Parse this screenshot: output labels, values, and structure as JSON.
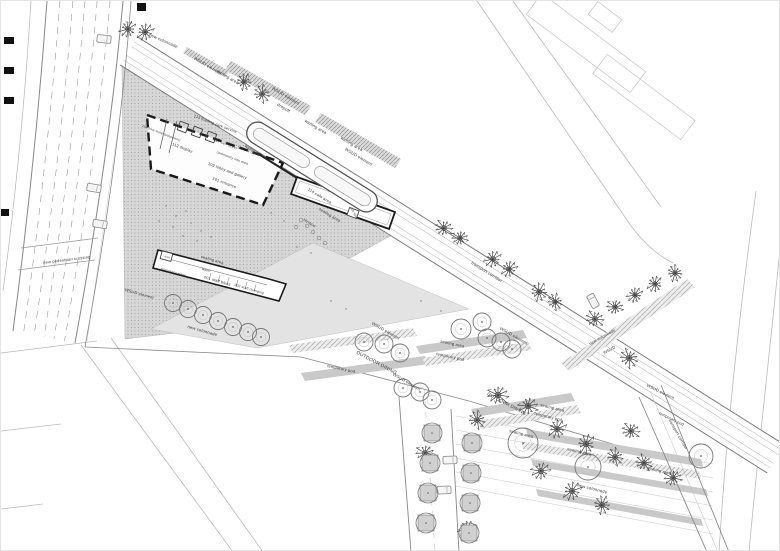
{
  "colors": {
    "paper": "#ffffff",
    "line_dark": "#555555",
    "line_mid": "#888888",
    "line_light": "#bbbbbb",
    "dot_zone_bg": "#d6d6d6",
    "dot_zone_dot": "#9a9a9a",
    "gray_zone": "#e3e3e3",
    "bar_gray": "#c9c9c9",
    "tree_stroke": "#444444",
    "round_tree_stroke": "#777777",
    "label_color": "#333333",
    "building_outline": "#1a1a1a"
  },
  "labels": [
    {
      "text": "new colonnade",
      "x": 162,
      "y": 41,
      "rot": 24,
      "size": 4.2
    },
    {
      "text": "WSUD element",
      "x": 206,
      "y": 66,
      "rot": 31,
      "size": 4.2
    },
    {
      "text": "waiting area",
      "x": 226,
      "y": 77,
      "rot": 31,
      "size": 4.2
    },
    {
      "text": "WSUD element",
      "x": 284,
      "y": 96,
      "rot": 31,
      "size": 4.2
    },
    {
      "text": "dropoff",
      "x": 282,
      "y": 108,
      "rot": 31,
      "size": 4.2
    },
    {
      "text": "waiting area",
      "x": 314,
      "y": 127,
      "rot": 31,
      "size": 4.2
    },
    {
      "text": "waiting area",
      "x": 350,
      "y": 144,
      "rot": 31,
      "size": 4.2
    },
    {
      "text": "WSUD element",
      "x": 357,
      "y": 157,
      "rot": 31,
      "size": 4.2
    },
    {
      "text": "waiting area",
      "x": 254,
      "y": 152,
      "rot": 31,
      "size": 4.2
    },
    {
      "text": "113 loading park service",
      "x": 214,
      "y": 124,
      "rot": 21,
      "size": 3.8
    },
    {
      "text": "104 bike store (basement)",
      "x": 160,
      "y": 133,
      "rot": 21,
      "size": 3.1
    },
    {
      "text": "112 display",
      "x": 181,
      "y": 148,
      "rot": 21,
      "size": 3.9
    },
    {
      "text": "107 self ticket",
      "x": 224,
      "y": 144,
      "rot": 21,
      "size": 3.6
    },
    {
      "text": "community info area",
      "x": 231,
      "y": 158,
      "rot": 21,
      "size": 3.3
    },
    {
      "text": "103 box office",
      "x": 247,
      "y": 151,
      "rot": 21,
      "size": 3.3
    },
    {
      "text": "102 lobby and gallery",
      "x": 226,
      "y": 171,
      "rot": 21,
      "size": 3.9
    },
    {
      "text": "101 entrance",
      "x": 223,
      "y": 183,
      "rot": 21,
      "size": 3.9
    },
    {
      "text": "114 cafe area",
      "x": 318,
      "y": 196,
      "rot": 31,
      "size": 4.0
    },
    {
      "text": "105 WC",
      "x": 352,
      "y": 212,
      "rot": 62,
      "size": 3.0
    },
    {
      "text": "seating area",
      "x": 328,
      "y": 215,
      "rot": 31,
      "size": 4.0
    },
    {
      "text": "terrace",
      "x": 308,
      "y": 223,
      "rot": 31,
      "size": 4.0
    },
    {
      "text": "exit",
      "x": 166,
      "y": 257,
      "rot": 16,
      "size": 3.0
    },
    {
      "text": "emergency stairs",
      "x": 172,
      "y": 272,
      "rot": 16,
      "size": 3.0
    },
    {
      "text": "seating area",
      "x": 211,
      "y": 260,
      "rot": 16,
      "size": 3.8
    },
    {
      "text": "water",
      "x": 205,
      "y": 270,
      "rot": 16,
      "size": 3.4
    },
    {
      "text": "001 staff bikes",
      "x": 216,
      "y": 281,
      "rot": 16,
      "size": 3.8
    },
    {
      "text": "002 staff changing",
      "x": 248,
      "y": 289,
      "rot": 16,
      "size": 3.3
    },
    {
      "text": "new pedestrian crossing",
      "x": 66,
      "y": 260,
      "rot": -7,
      "size": 4.0
    },
    {
      "text": "WSUD element",
      "x": 138,
      "y": 294,
      "rot": 16,
      "size": 4.0
    },
    {
      "text": "new colonnade",
      "x": 201,
      "y": 331,
      "rot": 16,
      "size": 4.2
    },
    {
      "text": "transport corridor",
      "x": 485,
      "y": 272,
      "rot": 32,
      "size": 4.2
    },
    {
      "text": "WSUD element",
      "x": 384,
      "y": 331,
      "rot": 30,
      "size": 4.2
    },
    {
      "text": "OUTDOOR DINING",
      "x": 375,
      "y": 363,
      "rot": 28,
      "size": 4.8
    },
    {
      "text": "temporary pod",
      "x": 340,
      "y": 369,
      "rot": 12,
      "size": 4.0
    },
    {
      "text": "WSUD element",
      "x": 405,
      "y": 382,
      "rot": 30,
      "size": 4.2
    },
    {
      "text": "seating area",
      "x": 451,
      "y": 344,
      "rot": 12,
      "size": 4.0
    },
    {
      "text": "temporary pod",
      "x": 449,
      "y": 357,
      "rot": 12,
      "size": 4.0
    },
    {
      "text": "WSUD element",
      "x": 512,
      "y": 336,
      "rot": 30,
      "size": 4.2
    },
    {
      "text": "new colonnade",
      "x": 602,
      "y": 337,
      "rot": -29,
      "size": 4.0
    },
    {
      "text": "WSUD",
      "x": 609,
      "y": 350,
      "rot": -29,
      "size": 4.0
    },
    {
      "text": "WSUD element",
      "x": 659,
      "y": 392,
      "rot": 26,
      "size": 4.0
    },
    {
      "text": "OUTDOOR DINING",
      "x": 505,
      "y": 404,
      "rot": 28,
      "size": 4.6
    },
    {
      "text": "seating area",
      "x": 551,
      "y": 408,
      "rot": 14,
      "size": 4.0
    },
    {
      "text": "temporary pod",
      "x": 547,
      "y": 417,
      "rot": 14,
      "size": 4.0
    },
    {
      "text": "seating area",
      "x": 520,
      "y": 434,
      "rot": 14,
      "size": 4.0
    },
    {
      "text": "seating area",
      "x": 578,
      "y": 452,
      "rot": 14,
      "size": 4.0
    },
    {
      "text": "seating area",
      "x": 658,
      "y": 471,
      "rot": 14,
      "size": 4.0
    },
    {
      "text": "new colonnade",
      "x": 591,
      "y": 489,
      "rot": 14,
      "size": 4.2
    },
    {
      "text": "temporary pod",
      "x": 670,
      "y": 419,
      "rot": 26,
      "size": 3.8
    },
    {
      "text": "transport corridor",
      "x": 676,
      "y": 434,
      "rot": 60,
      "size": 4.0
    }
  ],
  "trees": {
    "scribble": [
      {
        "x": 127,
        "y": 28,
        "r": 11
      },
      {
        "x": 144,
        "y": 31,
        "r": 11
      },
      {
        "x": 243,
        "y": 81,
        "r": 10
      },
      {
        "x": 261,
        "y": 93,
        "r": 11
      },
      {
        "x": 443,
        "y": 227,
        "r": 11
      },
      {
        "x": 459,
        "y": 237,
        "r": 10
      },
      {
        "x": 492,
        "y": 258,
        "r": 11
      },
      {
        "x": 508,
        "y": 268,
        "r": 10
      },
      {
        "x": 538,
        "y": 291,
        "r": 11
      },
      {
        "x": 554,
        "y": 301,
        "r": 10
      },
      {
        "x": 594,
        "y": 318,
        "r": 11
      },
      {
        "x": 614,
        "y": 306,
        "r": 10
      },
      {
        "x": 634,
        "y": 294,
        "r": 10
      },
      {
        "x": 654,
        "y": 283,
        "r": 10
      },
      {
        "x": 674,
        "y": 272,
        "r": 10
      },
      {
        "x": 628,
        "y": 357,
        "r": 12
      },
      {
        "x": 497,
        "y": 394,
        "r": 13
      },
      {
        "x": 527,
        "y": 405,
        "r": 12
      },
      {
        "x": 556,
        "y": 428,
        "r": 12
      },
      {
        "x": 585,
        "y": 443,
        "r": 12
      },
      {
        "x": 614,
        "y": 456,
        "r": 11
      },
      {
        "x": 643,
        "y": 462,
        "r": 11
      },
      {
        "x": 672,
        "y": 477,
        "r": 11
      },
      {
        "x": 540,
        "y": 470,
        "r": 12
      },
      {
        "x": 571,
        "y": 490,
        "r": 12
      },
      {
        "x": 601,
        "y": 504,
        "r": 11
      },
      {
        "x": 476,
        "y": 419,
        "r": 11
      },
      {
        "x": 630,
        "y": 430,
        "r": 11
      },
      {
        "x": 424,
        "y": 452,
        "r": 11
      },
      {
        "x": 466,
        "y": 528,
        "r": 11
      }
    ],
    "round": [
      {
        "x": 172,
        "y": 302,
        "r": 8.5
      },
      {
        "x": 187,
        "y": 308,
        "r": 8.5
      },
      {
        "x": 202,
        "y": 314,
        "r": 8.5
      },
      {
        "x": 217,
        "y": 320,
        "r": 8.5
      },
      {
        "x": 232,
        "y": 326,
        "r": 8.5
      },
      {
        "x": 247,
        "y": 331,
        "r": 8.5
      },
      {
        "x": 260,
        "y": 336,
        "r": 8.5
      },
      {
        "x": 363,
        "y": 341,
        "r": 9
      },
      {
        "x": 383,
        "y": 343,
        "r": 9
      },
      {
        "x": 399,
        "y": 352,
        "r": 9
      },
      {
        "x": 402,
        "y": 387,
        "r": 9
      },
      {
        "x": 419,
        "y": 391,
        "r": 9
      },
      {
        "x": 431,
        "y": 399,
        "r": 9
      },
      {
        "x": 460,
        "y": 328,
        "r": 10
      },
      {
        "x": 481,
        "y": 321,
        "r": 9
      },
      {
        "x": 486,
        "y": 337,
        "r": 9
      },
      {
        "x": 500,
        "y": 341,
        "r": 9
      },
      {
        "x": 511,
        "y": 348,
        "r": 9
      },
      {
        "x": 522,
        "y": 442,
        "r": 15
      },
      {
        "x": 587,
        "y": 466,
        "r": 13
      },
      {
        "x": 700,
        "y": 455,
        "r": 12
      }
    ],
    "planter": [
      {
        "x": 431,
        "y": 432,
        "r": 10
      },
      {
        "x": 429,
        "y": 462,
        "r": 10
      },
      {
        "x": 427,
        "y": 492,
        "r": 10
      },
      {
        "x": 425,
        "y": 522,
        "r": 10
      },
      {
        "x": 471,
        "y": 442,
        "r": 10
      },
      {
        "x": 470,
        "y": 472,
        "r": 10
      },
      {
        "x": 469,
        "y": 502,
        "r": 10
      },
      {
        "x": 468,
        "y": 532,
        "r": 10
      }
    ]
  },
  "terrace_tables": [
    {
      "x": 300,
      "y": 219
    },
    {
      "x": 306,
      "y": 225
    },
    {
      "x": 312,
      "y": 231
    },
    {
      "x": 318,
      "y": 237
    },
    {
      "x": 324,
      "y": 242
    },
    {
      "x": 295,
      "y": 226
    }
  ],
  "scatter_dots": [
    {
      "x": 165,
      "y": 205
    },
    {
      "x": 175,
      "y": 215
    },
    {
      "x": 185,
      "y": 210
    },
    {
      "x": 172,
      "y": 226
    },
    {
      "x": 190,
      "y": 222
    },
    {
      "x": 200,
      "y": 230
    },
    {
      "x": 158,
      "y": 220
    },
    {
      "x": 210,
      "y": 236
    },
    {
      "x": 182,
      "y": 235
    },
    {
      "x": 196,
      "y": 240
    },
    {
      "x": 270,
      "y": 212
    },
    {
      "x": 283,
      "y": 220
    },
    {
      "x": 296,
      "y": 246
    },
    {
      "x": 310,
      "y": 252
    },
    {
      "x": 330,
      "y": 300
    },
    {
      "x": 345,
      "y": 308
    },
    {
      "x": 420,
      "y": 300
    },
    {
      "x": 440,
      "y": 310
    }
  ],
  "vehicles": {
    "tram": {
      "x": 311,
      "y": 166,
      "rot": 32,
      "len": 150,
      "wid": 22
    },
    "cars": [
      {
        "x": 93,
        "y": 187,
        "rot": 99
      },
      {
        "x": 99,
        "y": 223,
        "rot": 99
      },
      {
        "x": 103,
        "y": 38,
        "rot": 96
      },
      {
        "x": 592,
        "y": 300,
        "rot": -28
      },
      {
        "x": 449,
        "y": 459,
        "rot": 88
      },
      {
        "x": 443,
        "y": 489,
        "rot": 88
      }
    ]
  },
  "section_markers": [
    {
      "x": 3,
      "y": 36,
      "w": 10,
      "h": 7
    },
    {
      "x": 3,
      "y": 66,
      "w": 10,
      "h": 7
    },
    {
      "x": 3,
      "y": 96,
      "w": 10,
      "h": 7
    },
    {
      "x": 136,
      "y": 2,
      "w": 9,
      "h": 8
    },
    {
      "x": 0,
      "y": 208,
      "w": 8,
      "h": 7
    }
  ]
}
